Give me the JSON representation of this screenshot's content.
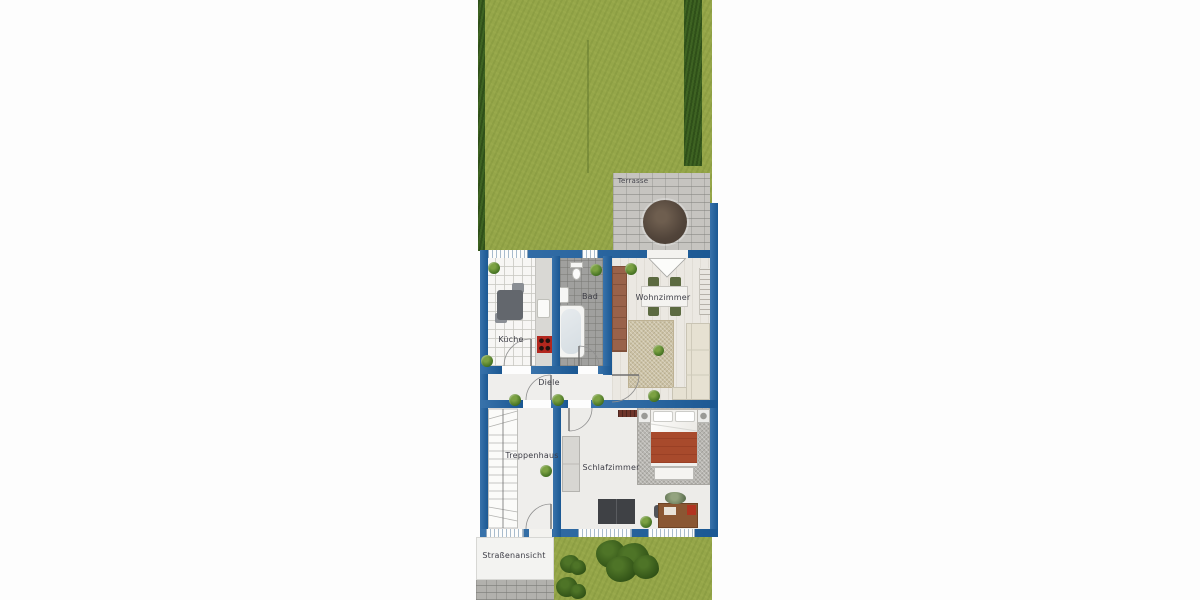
{
  "rooms": {
    "terrasse": "Terrasse",
    "kueche": "Küche",
    "bad": "Bad",
    "wohnzimmer": "Wohnzimmer",
    "diele": "Diele",
    "treppenhaus": "Treppenhaus",
    "schlafzimmer": "Schlafzimmer",
    "strassenansicht": "Straßenansicht"
  },
  "colors": {
    "wall_blue": "#1d5f9f",
    "lawn_green": "#95a649",
    "hedge_green": "#3e6322",
    "terrace_paving_gray": "#c6c4c0",
    "bath_tile_gray": "#a0a09e",
    "bed_blanket_rust": "#a84a2c",
    "stove_red": "#b3271e",
    "sideboard_brown": "#99624a",
    "desk_brown": "#8a5733",
    "sofa_beige": "#e6e1d2",
    "living_rug_beige": "#ccc2a5",
    "bedroom_rug_gray": "#b8b6b1"
  },
  "icons": {
    "plant": "green-circle",
    "tree": "dark-green-blob",
    "terrace_table": "brown-circle"
  }
}
